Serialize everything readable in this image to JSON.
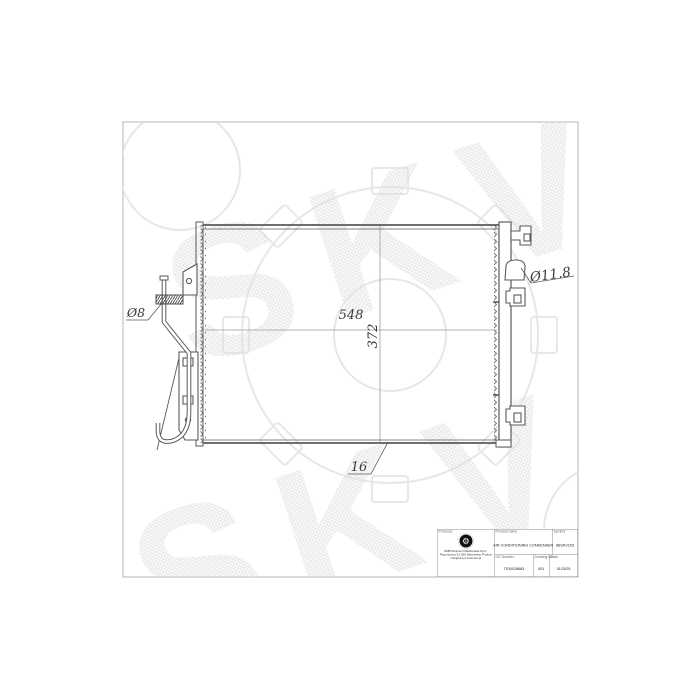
{
  "page": {
    "background": "#ffffff",
    "border_color": "#b5b5b5"
  },
  "watermark": {
    "text": "SKV",
    "hatch_color": "#e0e0e0",
    "gear_color": "#e7e7e7"
  },
  "drawing": {
    "line_color": "#5a5a5a",
    "centerline_color": "#9a9a9a",
    "dimensions": {
      "core_width": "548",
      "core_height": "372",
      "core_depth": "16",
      "pipe_diameter": "Ø8",
      "fitting_diameter": "Ø11.8"
    }
  },
  "title_block": {
    "producer_label": "Producer",
    "company_lines": [
      "SMB Wojciech Maćkowiak Sp.K.",
      "Poprzeczna 31-300 Warszawa, Poland",
      "info@skv.pl  www.skv.pl"
    ],
    "product_name_label": "Product name",
    "product_name": "AIR CONDITIONING CONDENSER",
    "symbol_label": "Symbol",
    "symbol": "86SKV153",
    "oe_number_label": "OE Number",
    "oe_number": "7700428883",
    "drawing_no_label": "Drawing No.",
    "drawing_no": "001",
    "date_label": "Date",
    "date": "01/2025"
  }
}
